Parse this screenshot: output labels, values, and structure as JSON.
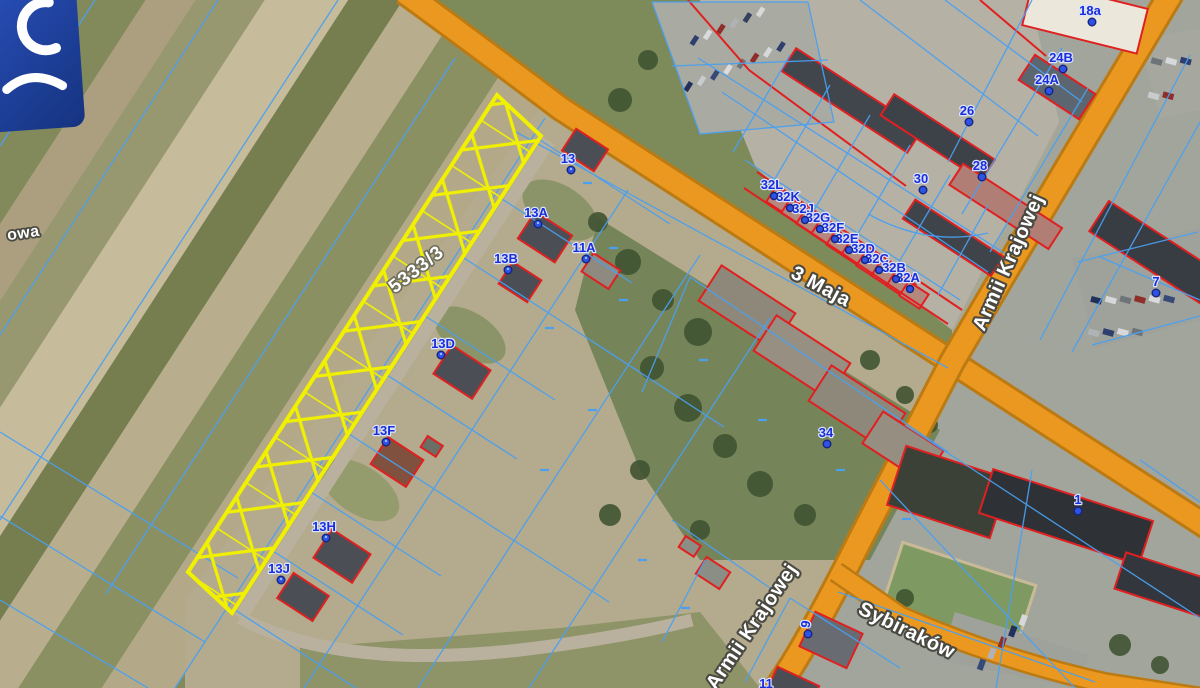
{
  "map": {
    "highlighted_parcel": {
      "id": "5333/3"
    },
    "road_labels": {
      "maja": "3 Maja",
      "armii_right": "Armii Krajowej",
      "armii_bottom": "Armii Krajowej",
      "sybirakow": "Sybiraków",
      "owa_partial": "owa"
    },
    "building_labels": [
      {
        "label": "13"
      },
      {
        "label": "13A"
      },
      {
        "label": "13B"
      },
      {
        "label": "11A"
      },
      {
        "label": "13D"
      },
      {
        "label": "13F"
      },
      {
        "label": "13H"
      },
      {
        "label": "13J"
      },
      {
        "label": "32L"
      },
      {
        "label": "32K"
      },
      {
        "label": "32J"
      },
      {
        "label": "32G"
      },
      {
        "label": "32F"
      },
      {
        "label": "32E"
      },
      {
        "label": "32D"
      },
      {
        "label": "32C"
      },
      {
        "label": "32B"
      },
      {
        "label": "32A"
      },
      {
        "label": "18a"
      },
      {
        "label": "24B"
      },
      {
        "label": "24A"
      },
      {
        "label": "26"
      },
      {
        "label": "28"
      },
      {
        "label": "30"
      },
      {
        "label": "34"
      },
      {
        "label": "1"
      },
      {
        "label": "7"
      },
      {
        "label": "9"
      },
      {
        "label": "11"
      }
    ],
    "colors": {
      "parcel_highlight": "#F0F000",
      "cadastral_line": "#4AA0F0",
      "building_outline": "#E02020",
      "road_fill": "#EA9820",
      "road_casing": "#BC7A12",
      "address_label": "#1B2CD8"
    }
  }
}
